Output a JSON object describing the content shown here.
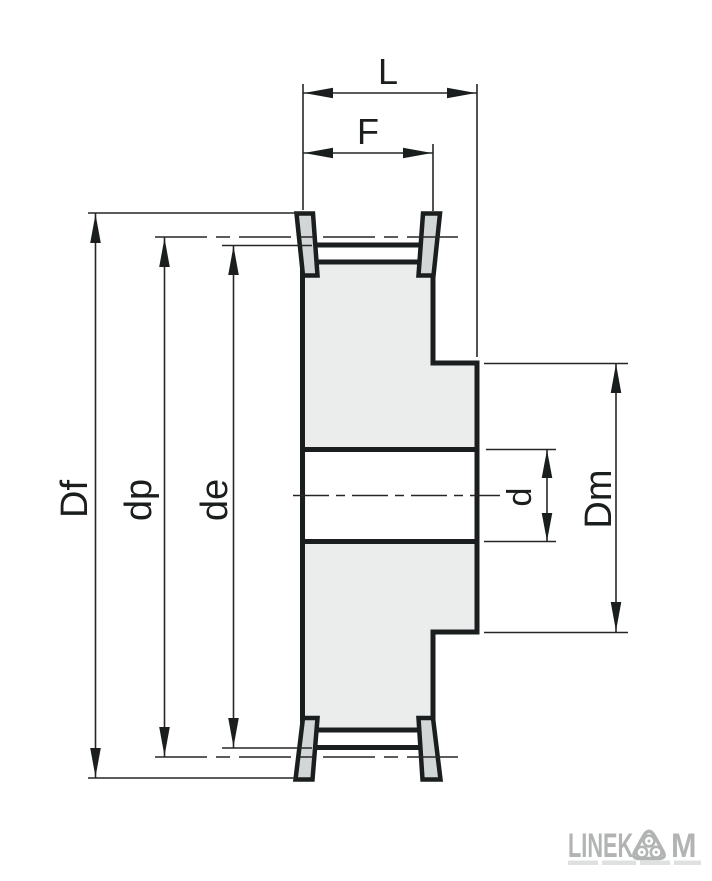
{
  "drawing": {
    "kind": "timing-pulley-cross-section-diagram"
  },
  "dims": {
    "L": "L",
    "F": "F",
    "Df": "Df",
    "dp": "dp",
    "de": "de",
    "d": "d",
    "Dm": "Dm"
  },
  "logo": {
    "part1": "LINEK",
    "part2": "M",
    "icon": "triple-roller-triangle-icon",
    "color": "#b2b4b4"
  },
  "colors": {
    "background": "#ffffff",
    "outline": "#1b1e1f",
    "body_fill": "#ebecec",
    "flange_fill": "#d3d6d6",
    "dimension_line": "#262626",
    "logo_gray": "#b2b4b4"
  }
}
